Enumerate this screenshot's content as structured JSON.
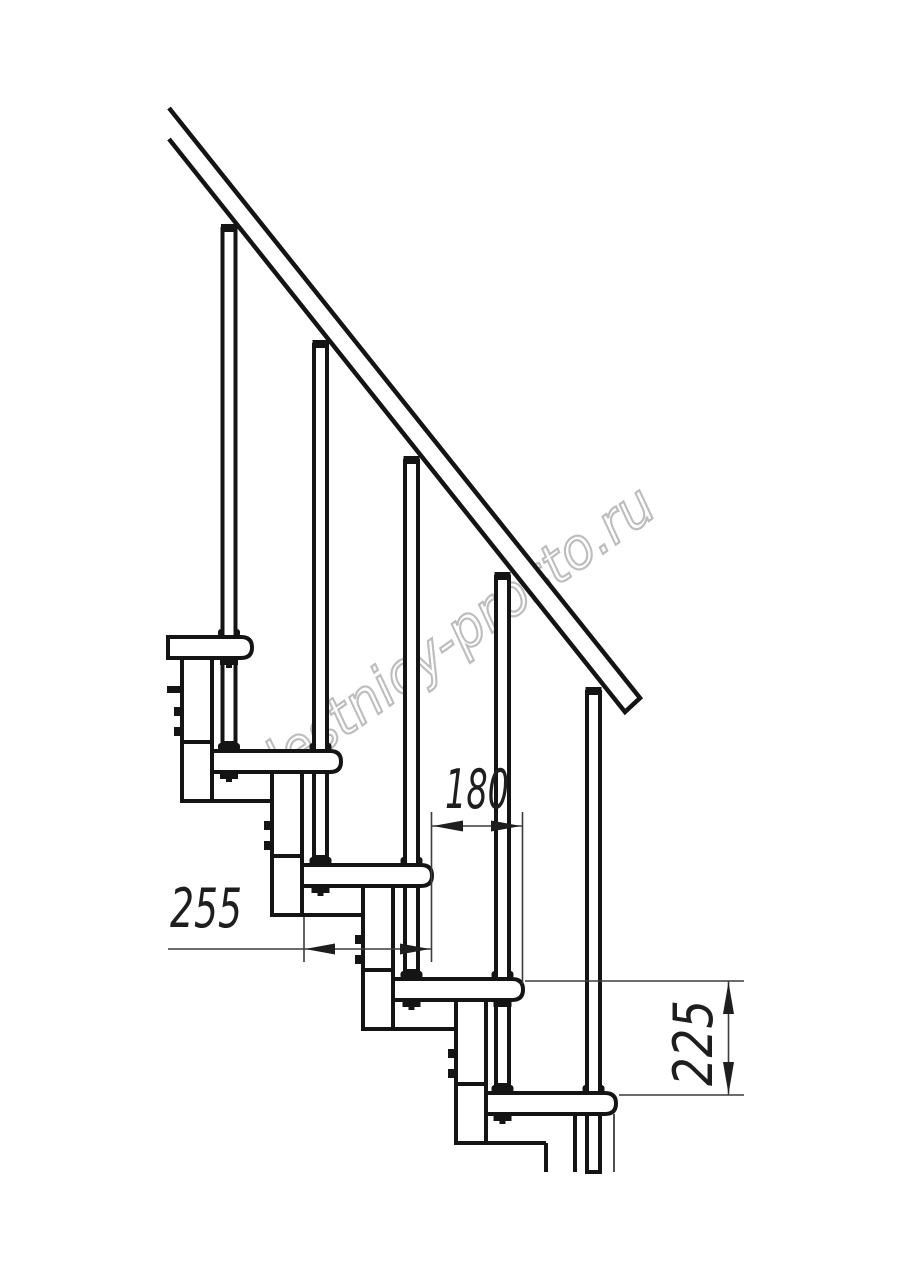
{
  "drawing": {
    "subject": "modular-staircase-side-elevation",
    "steps_visible": 5,
    "balusters_visible": 5,
    "handrail": true
  },
  "dimensions": {
    "step_run": "180",
    "tread_depth": "255",
    "step_rise": "225"
  },
  "watermark": {
    "text": "lestnicy-prosto.ru",
    "color": "#bdbdbd"
  },
  "colors": {
    "background": "#ffffff",
    "line": "#141414",
    "dimension_line": "#3c3c3c",
    "dimension_text": "#1e1e1e"
  }
}
